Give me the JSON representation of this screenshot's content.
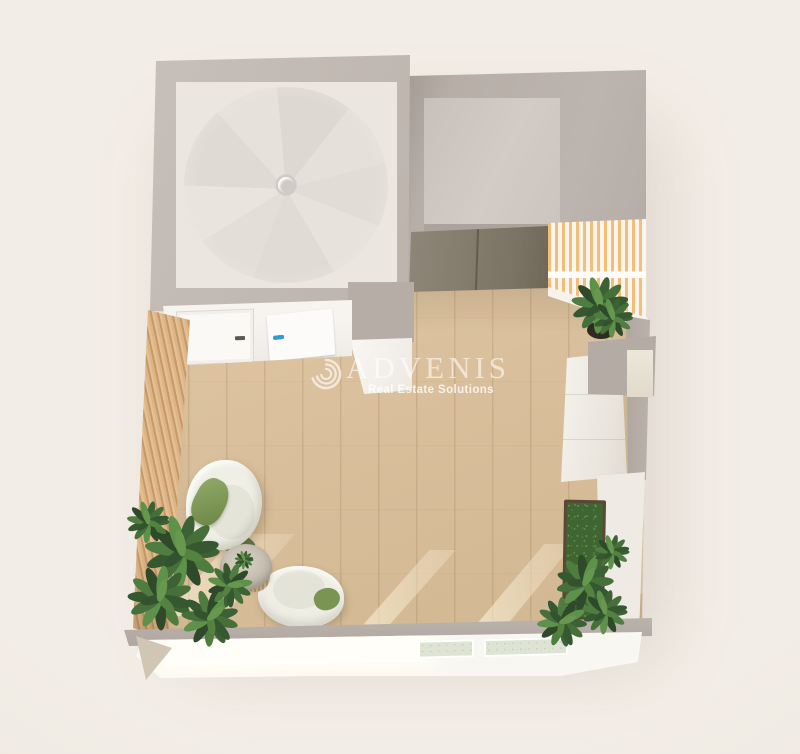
{
  "meta": {
    "description": "Isometric 3D floor-plan rendering of a studio room with wood floor, lounge chairs, plants, spiral-staircase room and elevator, watermarked ADVENIS",
    "canvas": {
      "width": 800,
      "height": 754
    }
  },
  "watermark": {
    "brand": "ADVENIS",
    "tagline": "Real Estate Solutions",
    "logo_icon": "swirl-logo",
    "text_color": "#FFFFFF"
  },
  "poster": {
    "rows": [
      {
        "style": "background:#3E7BC4"
      },
      {
        "style": "background:#D95B43"
      },
      {
        "style": "background:#E8A33A"
      },
      {
        "style": "background:#2E9BD6"
      }
    ]
  },
  "palette": {
    "background": "#F0EBE3",
    "wall_gray": "#BCB3AD",
    "faded_floor": "#EBE6E0",
    "stair_tread": "#E0DAD4",
    "wall_white": "#F5F2ED",
    "wood_floor": "#D8BE9A",
    "slat_wood": "#D2A878",
    "elevator_door": "#857D6E",
    "stripe_orange": "#F2BC74",
    "stripe_white": "#F9F4ED",
    "plant_green_dark": "#2F4A2C",
    "plant_green": "#4C7A3E",
    "plant_green_light": "#6FA050",
    "chair_cream": "#ECECE2",
    "cushion_green": "#7C9156",
    "table_top": "#CCC5B8",
    "moss_green": "#47703A",
    "planter_frame": "#5A4836",
    "sunlight": "#FDF3DB",
    "window_glass_green": "#DEE4D4"
  }
}
